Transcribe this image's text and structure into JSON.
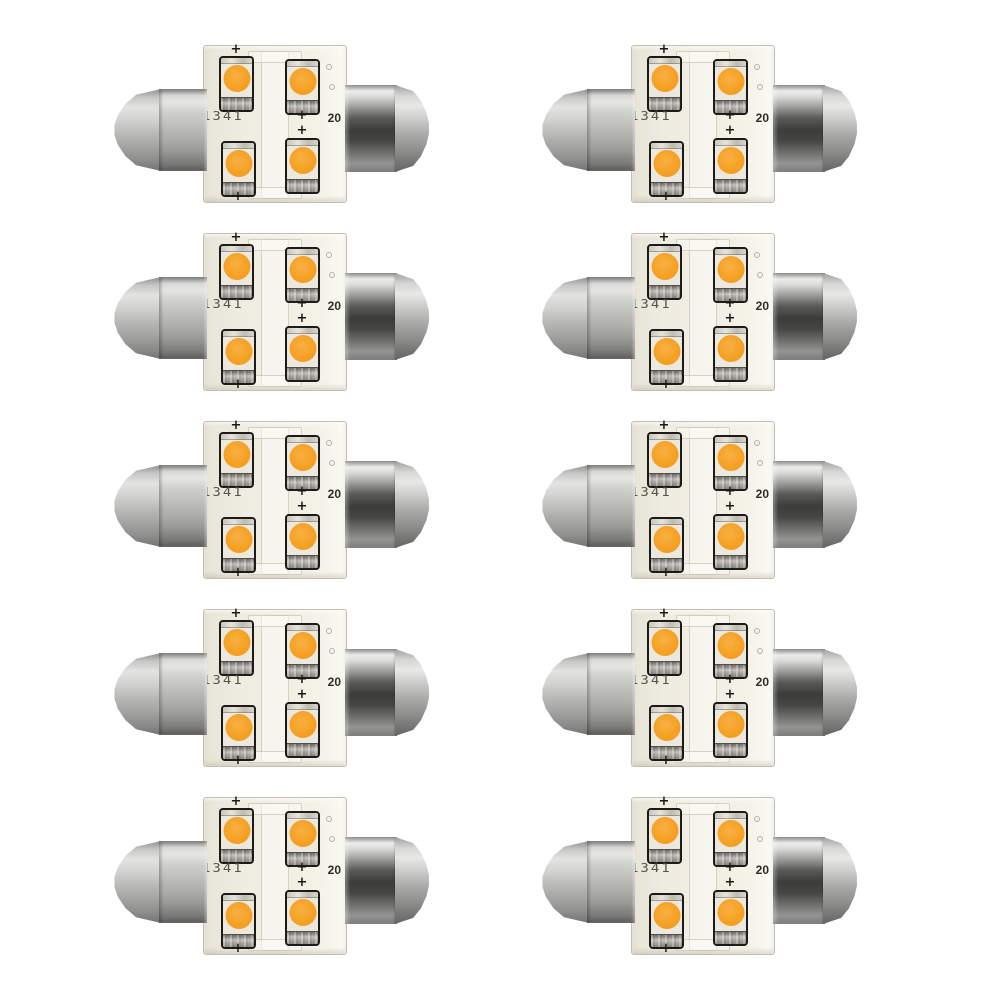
{
  "product": {
    "name": "festoon LED bulb 10-pack",
    "grid": {
      "rows": 5,
      "columns": 2,
      "count": 10
    }
  },
  "bulb": {
    "marking_left": "1341",
    "marking_right": "20",
    "polarity_mark": "+",
    "led_count": 4
  },
  "colors": {
    "background": "#ffffff",
    "pcb": "#efece1",
    "pcb_edge": "#c2bfae",
    "led_amber": "#f5a124",
    "led_amber_highlight": "#f8b043",
    "module_body": "#ece8dd",
    "module_outline": "#1b1b19",
    "electrode_gray": "#a5a39c",
    "metal_highlight": "#e6e6e4",
    "metal_mid": "#b3b3b1",
    "metal_dark": "#3c3c3a",
    "marking_color": "#4a4840"
  }
}
